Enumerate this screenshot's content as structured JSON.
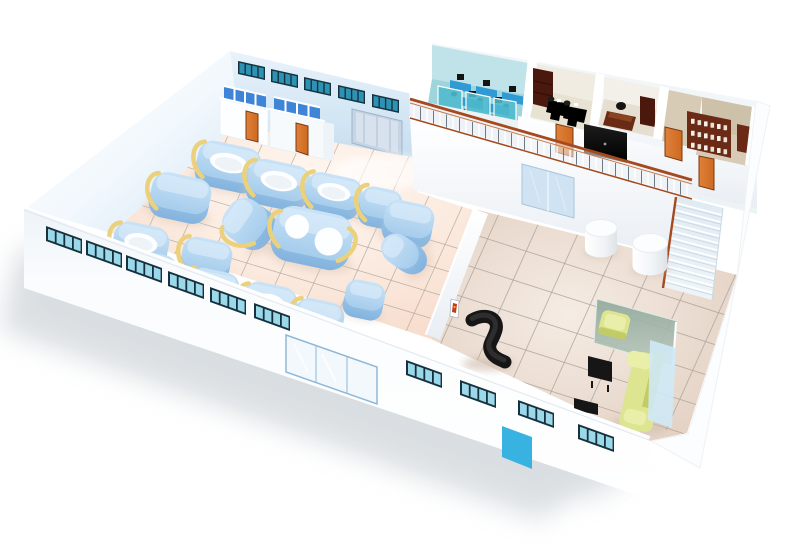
{
  "scene": {
    "kind": "isometric-3d-floorplan-render",
    "areas": [
      {
        "id": "production-hall",
        "contents": [
          "blue-process-machines",
          "yellow-hoses",
          "changing-rooms",
          "roller-door",
          "tiled-floor"
        ]
      },
      {
        "id": "office-mezzanine",
        "contents": [
          "open-plan-office",
          "office-room",
          "manager-office",
          "archive-room",
          "orange-doors",
          "ornate-railing"
        ]
      },
      {
        "id": "lobby",
        "contents": [
          "reception-desk",
          "round-stools",
          "coffee-tables",
          "sofa-set",
          "glass-partition",
          "staircase",
          "entrance-door"
        ]
      }
    ],
    "machine_count": 16,
    "round_stool_count": 2,
    "orange_door_count": 5
  },
  "colors": {
    "bg": "#ffffff",
    "shadow": "#b9c2c9",
    "wall_white": "#ffffff",
    "wall_shade": "#e9eef4",
    "west_wall_blue": "#d3e5f4",
    "back_wall_blue": "#c6def0",
    "back_wall_blue_light": "#e9f3fb",
    "window_frame_dark": "#17323e",
    "window_pane_teal": "#2d93b4",
    "window_pane_light": "#9bd8ea",
    "roller_door": "#c6d4e3",
    "roller_door_line": "#aebfd2",
    "orange_door": "#cd6a20",
    "orange_door_dark": "#7a3a10",
    "stall_blue": "#3e85d8",
    "floor_hall_center": "#fff8f2",
    "floor_hall_edge": "#f6d8c7",
    "floor_lobby_center": "#f5ece4",
    "floor_lobby_edge": "#e0cbbc",
    "grid_line": "#aba39b",
    "machine_blue": "#a6cdec",
    "machine_blue_dark": "#83b3de",
    "machine_top": "#c9e2f6",
    "machine_oval": "#fdfeff",
    "hose_yellow": "#ecd17c",
    "mezz_floor": "#edf2f5",
    "rail_brown": "#a5491f",
    "rail_brown_light": "#c97a4a",
    "baluster_gray": "#5d6d78",
    "office_teal_wall": "#bfe3e8",
    "office_teal_floor": "#9ed4dc",
    "office_teal_glass": "#4fb9cc",
    "desk_blue": "#2f9ad4",
    "monitor_black": "#141414",
    "office_wood": "#6b2a15",
    "office_wood_dark": "#4a180d",
    "room_tan_wall": "#cec1a9",
    "room_tan_floor": "#d8cbb5",
    "black_furniture": "#161616",
    "slab_black": "#0e0e0e",
    "sofa_yellow": "#dde590",
    "sofa_yellow_dark": "#c3cb67",
    "sofa_yellow_light": "#e9efa8",
    "glass_green_a": "#8fa79b",
    "glass_green_b": "#b7c8bb",
    "stair_step": "#dfeaf2",
    "stair_line": "#c3d2dd",
    "sliding_door": "#cfe3f2",
    "sliding_door_frame": "#a9c4da",
    "cyan_door": "#38b2e0",
    "glass_door_pane": "#f2f8fc",
    "glass_door_frame": "#8fb8d8",
    "east_glass": "#cfe9f6",
    "cylinder_top": "#fcfdfe",
    "cylinder_shade": "#dde3e8",
    "poster_red": "#c43b1e"
  }
}
